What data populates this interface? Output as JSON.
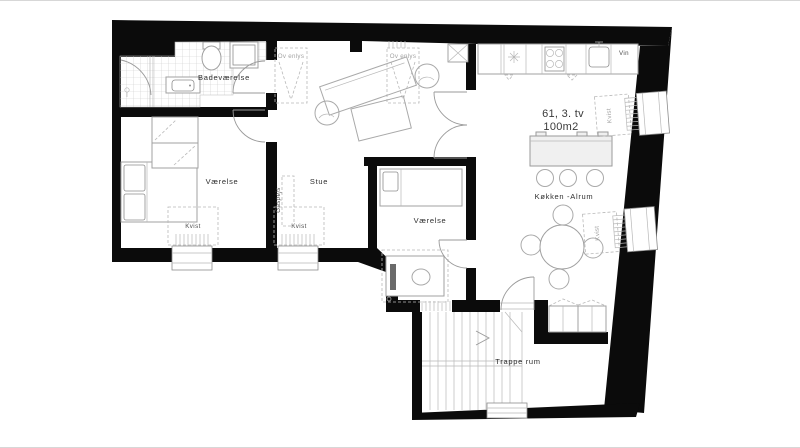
{
  "plan": {
    "unit": {
      "title": "61, 3. tv",
      "area": "100m2"
    },
    "rooms": {
      "bathroom": "Badeværelse",
      "bedroom1": "Værelse",
      "living": "Stue",
      "bedroom2": "Værelse",
      "kitchen_dining": "Køkken -Alrum",
      "stairwell": "Trappe rum"
    },
    "features": {
      "fireplace": "Gaspejs",
      "skylight": "Ov enlys",
      "wine_cooler": "Vin",
      "dormer": "Kvist"
    },
    "colors": {
      "wall": "#0b0b0b",
      "furniture_line": "#a9a9a9",
      "label": "#2e2e2e",
      "muted_label": "#a3a3a3"
    }
  }
}
